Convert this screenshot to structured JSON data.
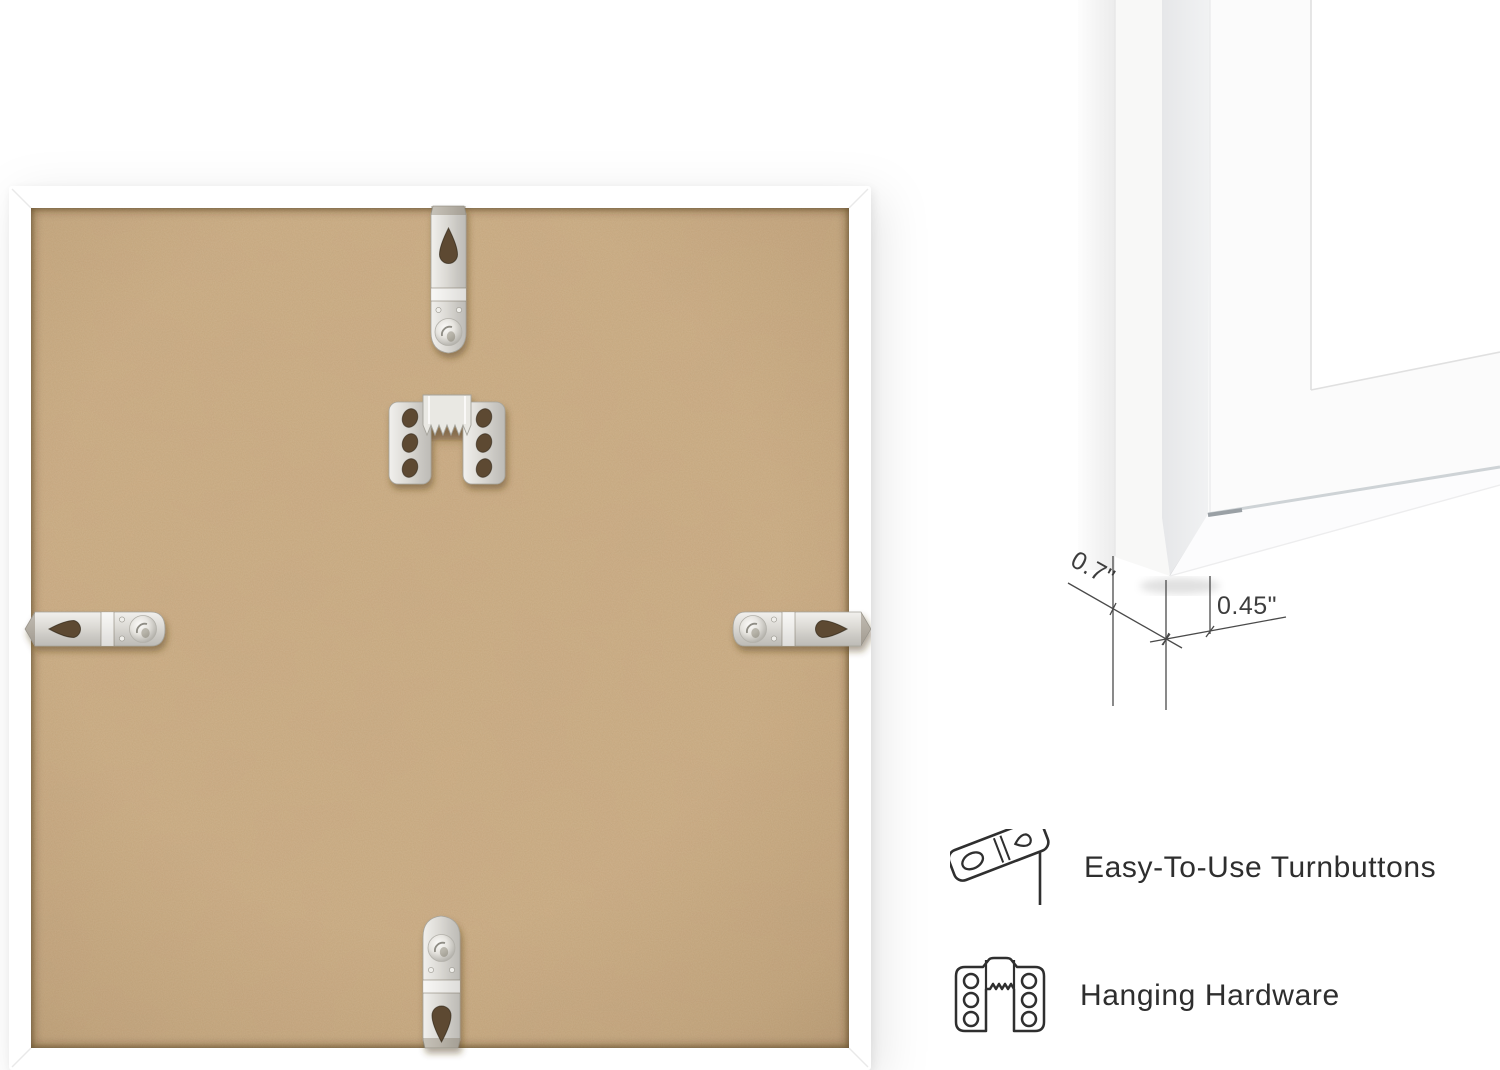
{
  "back_photo": {
    "subject": "frame-back-with-mounting-hardware",
    "frame_color": "#ffffff",
    "board_color": "#c8a77d",
    "hardware": [
      "turnbutton-top",
      "sawtooth-hanger",
      "turnbutton-left",
      "turnbutton-right",
      "turnbutton-bottom"
    ]
  },
  "profile_photo": {
    "subject": "frame-corner-profile",
    "dimensions": {
      "depth": "0.7\"",
      "face": "0.45\""
    }
  },
  "callouts": [
    {
      "icon": "turnbutton-icon",
      "label": "Easy-To-Use Turnbuttons"
    },
    {
      "icon": "hanging-hardware-icon",
      "label": "Hanging Hardware"
    }
  ],
  "colors": {
    "text": "#2e2e2e",
    "dimension_line": "#4a4a4a",
    "metal": "#d8d6d1",
    "hole": "#5d4a33"
  }
}
